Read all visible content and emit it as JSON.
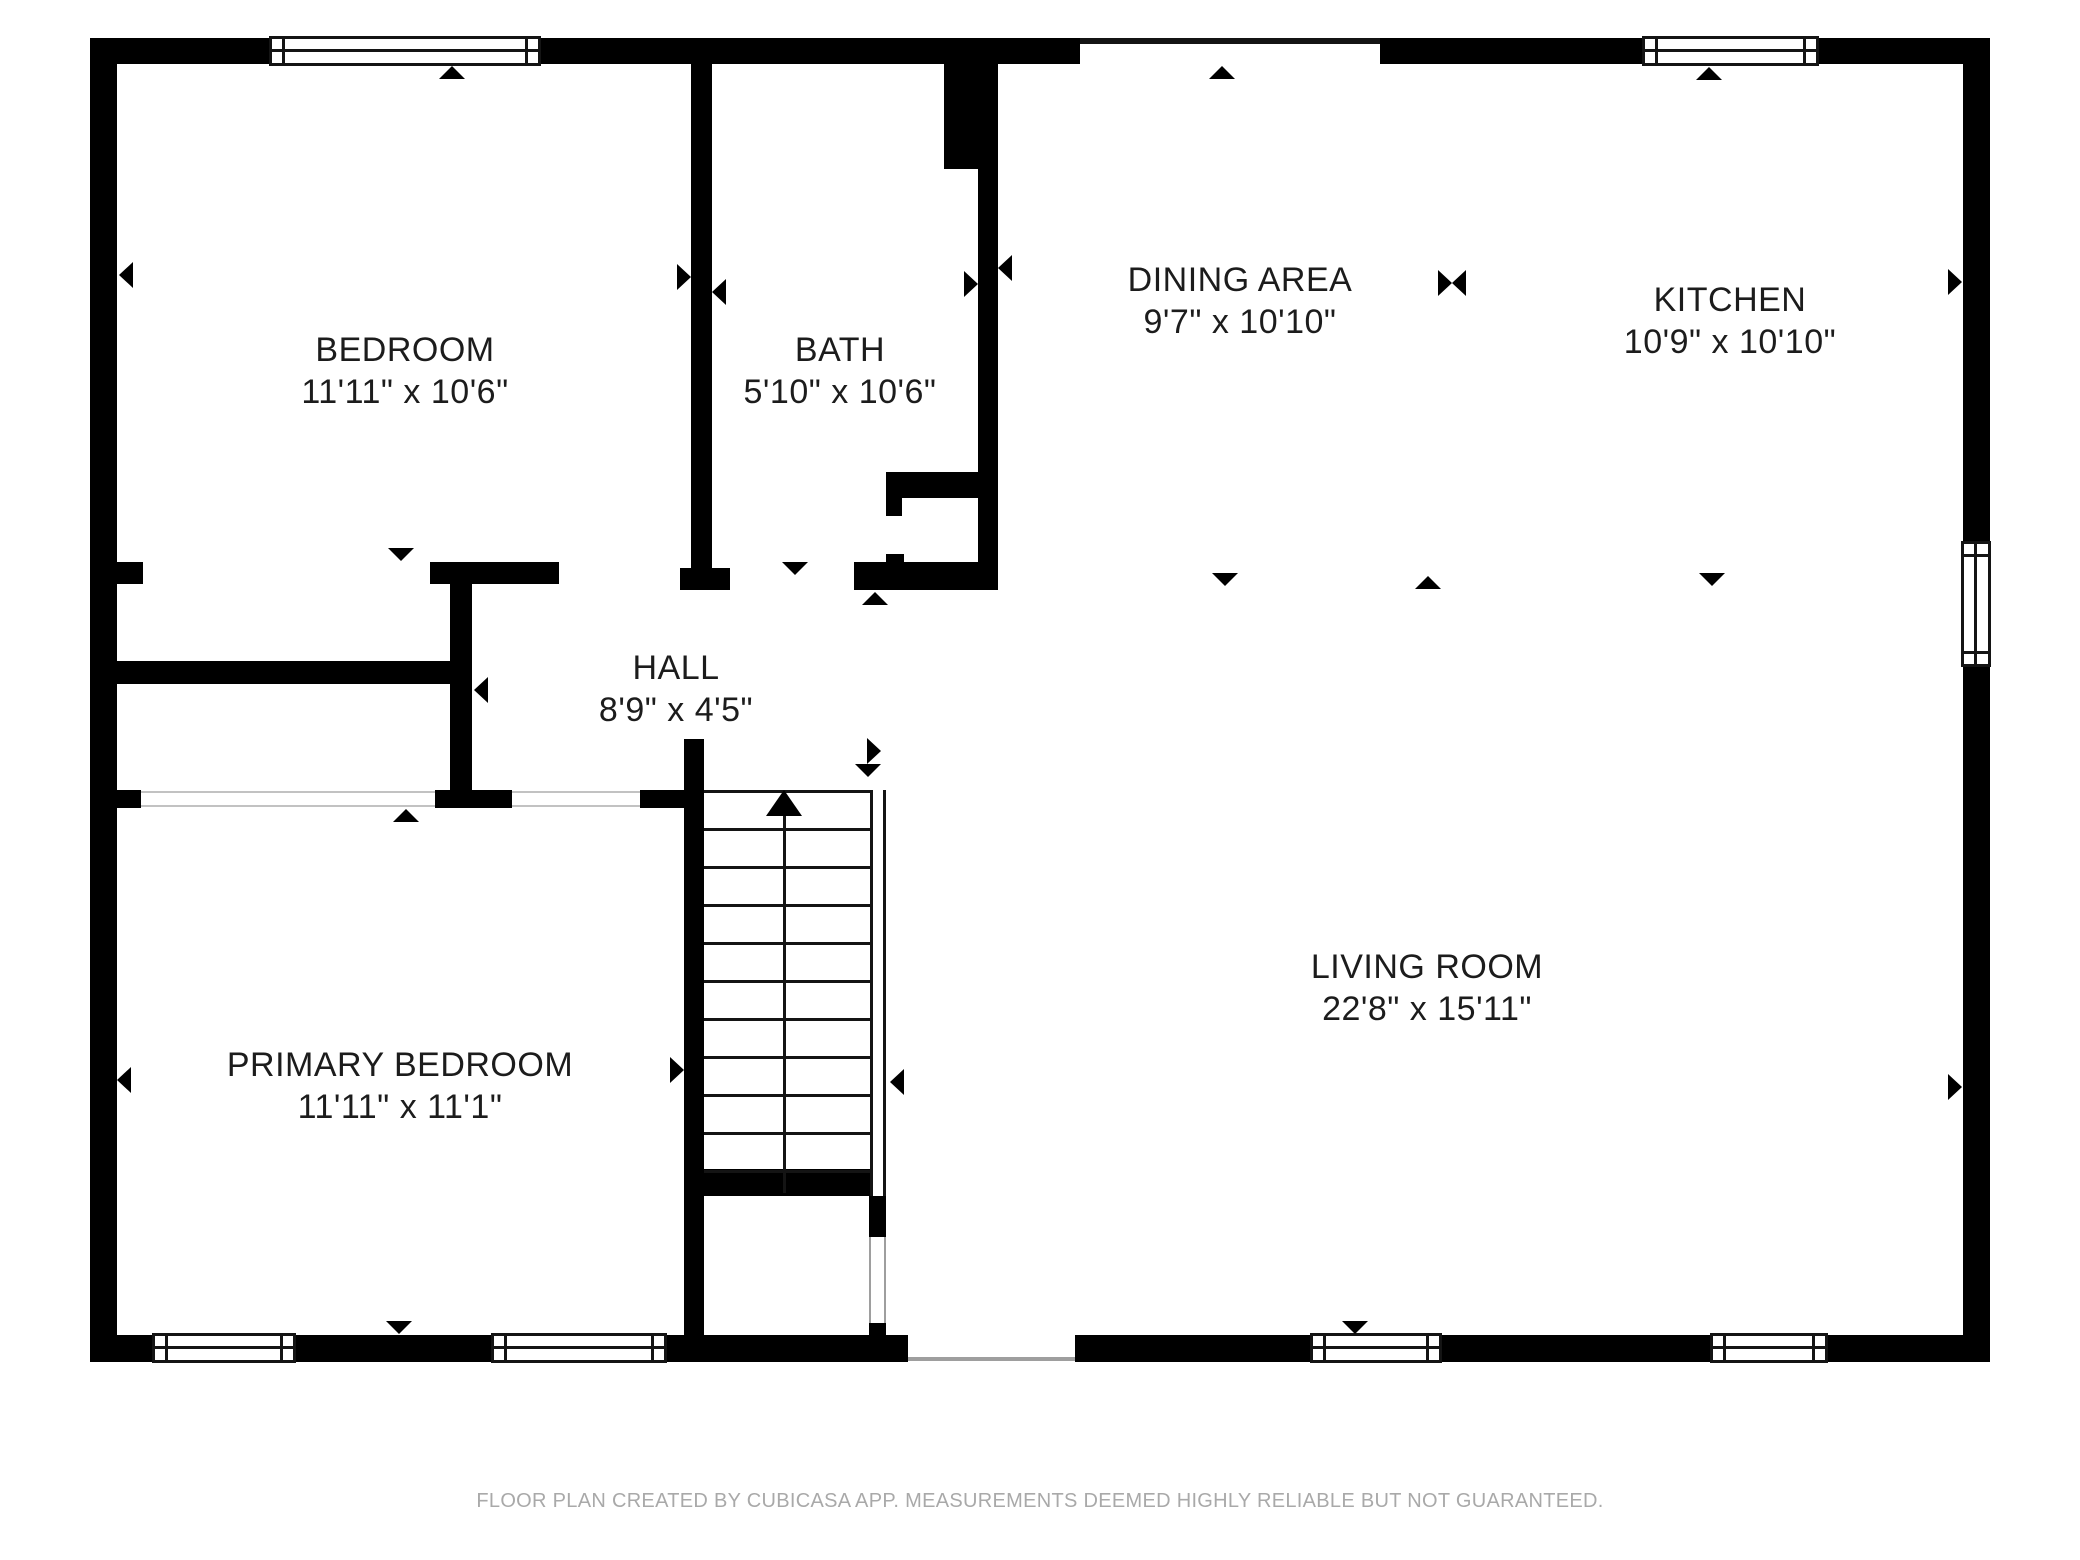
{
  "rooms": {
    "bedroom": {
      "name": "BEDROOM",
      "dims": "11'11\" x 10'6\""
    },
    "bath": {
      "name": "BATH",
      "dims": "5'10\" x 10'6\""
    },
    "dining": {
      "name": "DINING AREA",
      "dims": "9'7\" x 10'10\""
    },
    "kitchen": {
      "name": "KITCHEN",
      "dims": "10'9\" x 10'10\""
    },
    "hall": {
      "name": "HALL",
      "dims": "8'9\" x 4'5\""
    },
    "living": {
      "name": "LIVING ROOM",
      "dims": "22'8\" x 15'11\""
    },
    "primary": {
      "name": "PRIMARY BEDROOM",
      "dims": "11'11\" x 11'1\""
    }
  },
  "footer": {
    "text": "FLOOR PLAN CREATED BY CUBICASA APP. MEASUREMENTS DEEMED HIGHLY RELIABLE BUT NOT GUARANTEED."
  },
  "colors": {
    "wall": "#000000",
    "label_text": "#1c1c1c",
    "footer_text": "#a9a9a9",
    "opening_line": "#c2c2c2",
    "stair_line": "#141414"
  }
}
